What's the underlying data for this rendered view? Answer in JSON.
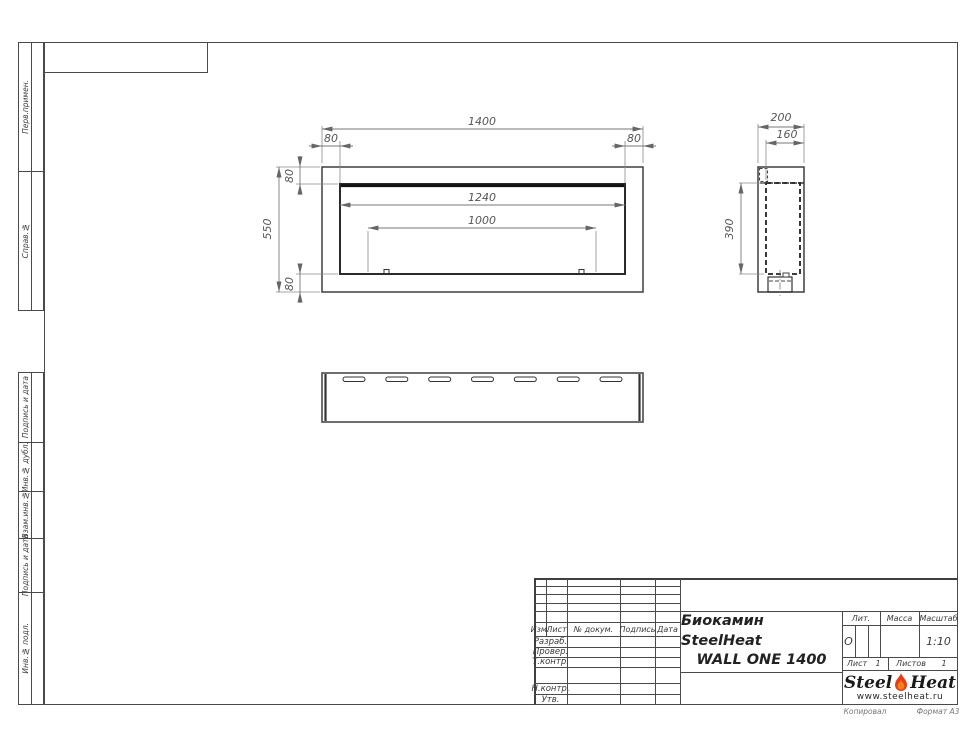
{
  "sidebar": {
    "labels": [
      "Перв.примен.",
      "Справ.№",
      "Подпись и дата",
      "Инв.№ дубл.",
      "Взам.инв.№",
      "Подпись и дата",
      "Инв.№ подл."
    ]
  },
  "dimensions": {
    "front": {
      "width": "1400",
      "side_inset_left": "80",
      "side_inset_right": "80",
      "height": "550",
      "top_inset": "80",
      "bottom_inset": "80",
      "opening_width": "1240",
      "burner_width": "1000"
    },
    "side": {
      "depth": "200",
      "inner_depth": "160",
      "opening_height": "390"
    }
  },
  "title_block": {
    "product_title_line1": "Биокамин SteelHeat",
    "product_title_line2": "WALL ONE 1400",
    "header_columns": [
      "Изм.",
      "Лист",
      "№ докум.",
      "Подпись",
      "Дата"
    ],
    "row_labels": [
      "Разраб.",
      "Провер.",
      "Т.контр.",
      "Н.контр.",
      "Утв."
    ],
    "lit_label": "Лит.",
    "lit_value": "О",
    "mass_label": "Масса",
    "scale_label": "Масштаб",
    "scale_value": "1:10",
    "sheet_label": "Лист",
    "sheet_value": "1",
    "sheets_label": "Листов",
    "sheets_value": "1"
  },
  "logo": {
    "brand_part1": "Steel",
    "brand_part2": "Heat",
    "website": "www.steelheat.ru"
  },
  "footer": {
    "copied_by": "Копировал",
    "format": "Формат А3"
  },
  "colors": {
    "flame_red": "#e63c18",
    "flame_orange": "#f08018",
    "line_dark": "#2a2a2a",
    "line_gray": "#777777"
  }
}
